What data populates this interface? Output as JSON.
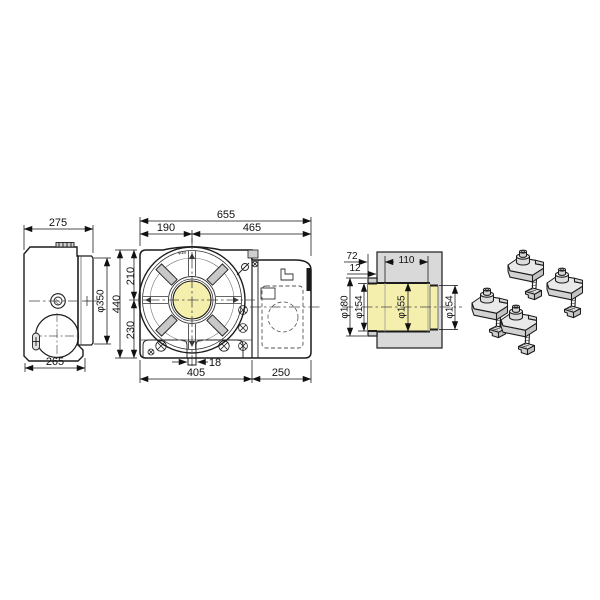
{
  "drawing": {
    "background": "#ffffff",
    "colors": {
      "body_fill": "#d9d9d9",
      "shade_fill": "#cbcbcb",
      "bore_fill": "#f5efad",
      "outline": "#1c1c1c",
      "dim_color": "#111111"
    },
    "side_view": {
      "width_top": "275",
      "base_width": "265",
      "table_diameter": "φ350"
    },
    "front_view": {
      "overall_width": "655",
      "center_offset_left": "190",
      "center_offset_right": "465",
      "overall_height": "440",
      "center_to_top": "210",
      "center_to_bottom": "230",
      "key_width": "18",
      "base_width": "405",
      "motor_section_width": "250",
      "slot_callout": "φ18"
    },
    "section_view": {
      "pilot_depth": "72",
      "flange_thickness": "12",
      "bore_length": "110",
      "pilot_diameter": "φ180",
      "bore_rear": "φ154",
      "bore_center": "φ155",
      "bore_front": "φ154"
    }
  }
}
